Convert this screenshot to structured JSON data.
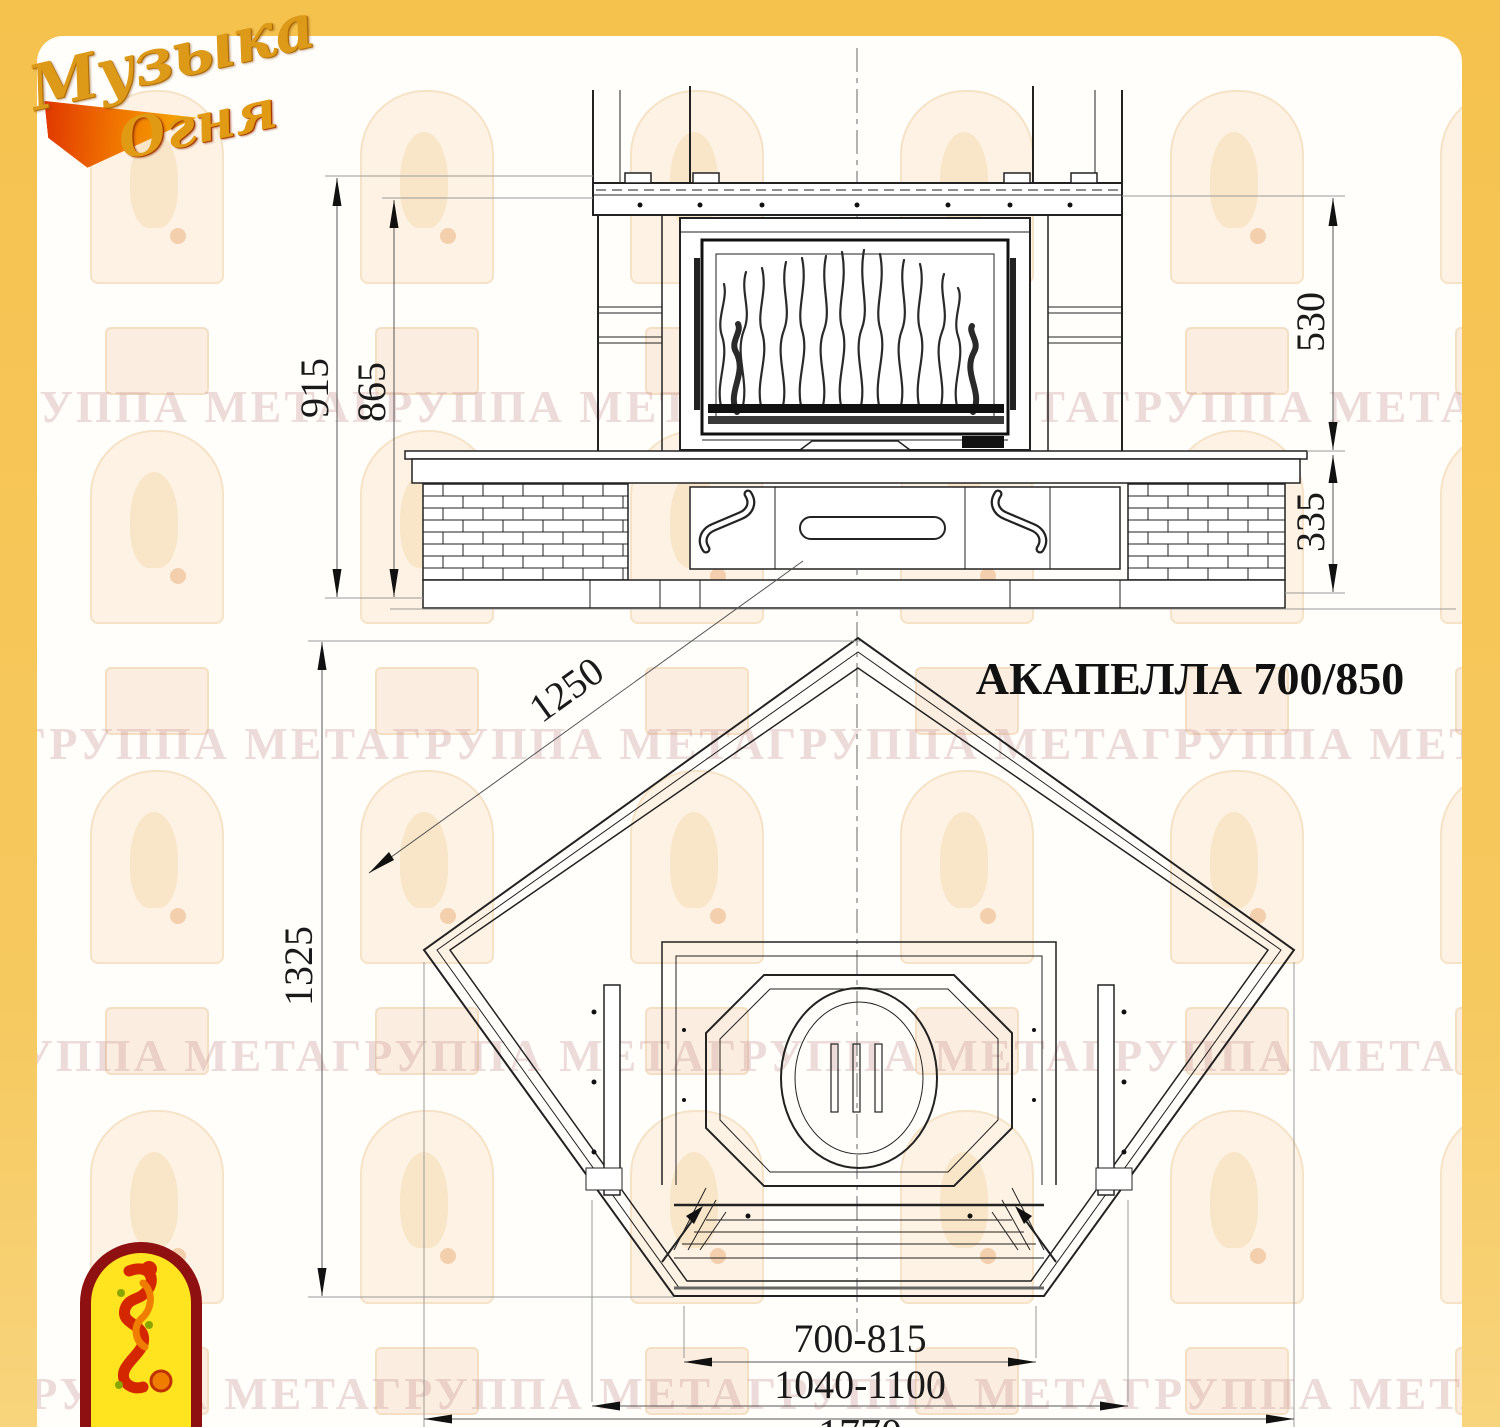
{
  "title": "АКАПЕЛЛА 700/850",
  "logo": {
    "line1": "Музыка",
    "line2": "Огня"
  },
  "watermark": {
    "text": "ГРУППА МЕТАГРУППА МЕТАГРУППА МЕТАГРУППА МЕТА"
  },
  "colors": {
    "border_yellow": "#f5c24e",
    "paper": "#fffefb",
    "line_dark": "#222222",
    "line_light": "#999999",
    "emblem_red": "#8f1010",
    "emblem_yellow": "#ffe41f",
    "logo_gold": "#dc9a18"
  },
  "dimensions": {
    "front_total_height": "915",
    "front_body_height": "865",
    "firebox_height": "530",
    "base_height": "335",
    "side_depth": "1250",
    "plan_depth": "1325",
    "opening_width": "700-815",
    "panel_width": "1040-1100",
    "overall_width": "1770"
  }
}
